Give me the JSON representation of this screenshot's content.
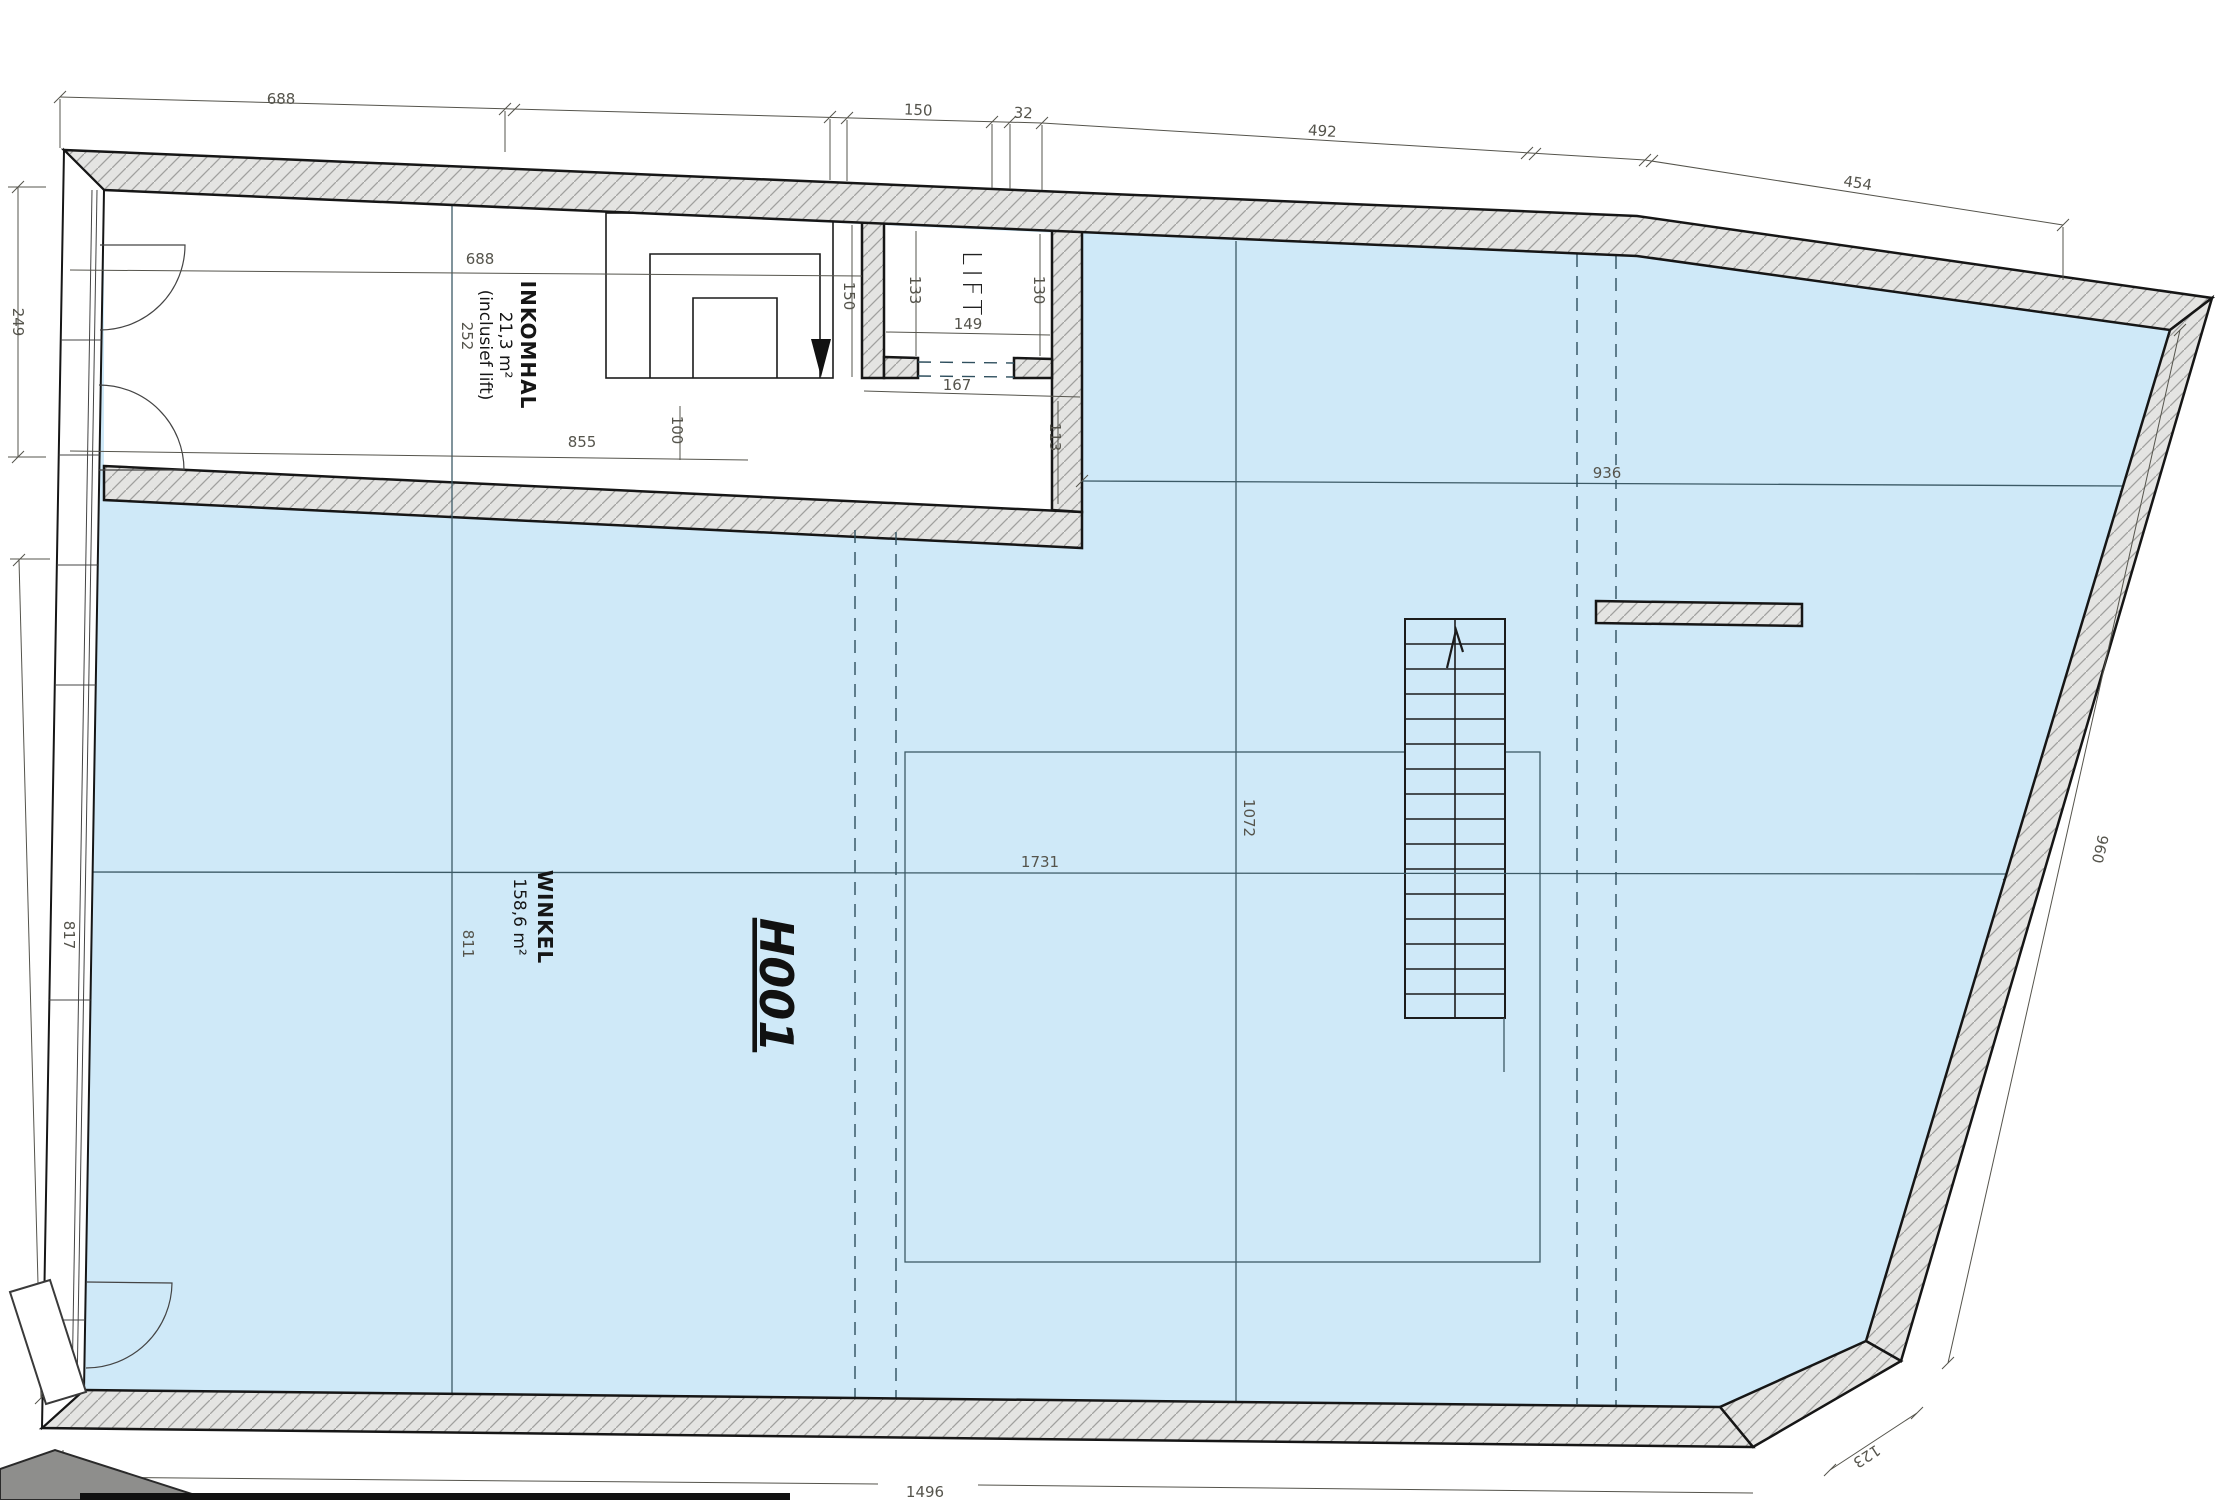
{
  "plan": {
    "rooms": {
      "inkomhal": {
        "name": "INKOMHAL",
        "area": "21,3 m²",
        "note": "(inclusief lift)"
      },
      "winkel": {
        "name": "WINKEL",
        "area": "158,6 m²",
        "code": "H001"
      },
      "lift": {
        "name": "LIFT"
      }
    },
    "dims": {
      "top": [
        "688",
        "150",
        "32",
        "492",
        "454"
      ],
      "left": [
        "249",
        "817"
      ],
      "right": [
        "960"
      ],
      "bottom": [
        "1496",
        "123"
      ],
      "inner": {
        "hall_width": "688",
        "hall_depth": "252",
        "hall_floor": "855",
        "hall_step": "100",
        "stair_run": "150",
        "lift_w1": "133",
        "lift_w2": "130",
        "lift_d": "149",
        "lift_front": "167",
        "lobby": "113",
        "shop_back_width": "936",
        "shop_width": "1731",
        "shop_depth": "1072",
        "shop_front_depth": "811"
      }
    }
  },
  "colors": {
    "floor": "#cfe9f8",
    "wall_fill": "#e4e4e2",
    "hatch_line": "#a0a09e",
    "outline": "#161616",
    "ref_line": "#3c5a66",
    "dim_text": "#55544c"
  }
}
